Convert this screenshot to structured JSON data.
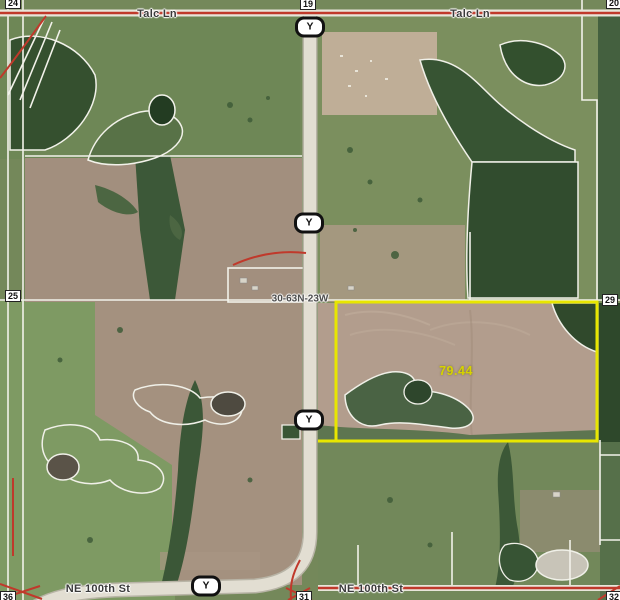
{
  "map": {
    "type": "county-gis-aerial-parcel-map",
    "township_range_label": "30-63N-23W",
    "highlighted_parcel": {
      "acreage": "79.44",
      "outline_color": "#e8e600"
    },
    "road_names": {
      "talc_ln_west": "Talc Ln",
      "talc_ln_east": "Talc Ln",
      "ne_100th_st_west": "NE 100th St",
      "ne_100th_st_east": "NE 100th St"
    },
    "route_shields": [
      {
        "route": "Y",
        "position": "top"
      },
      {
        "route": "Y",
        "position": "upper-middle"
      },
      {
        "route": "Y",
        "position": "lower-middle"
      },
      {
        "route": "Y",
        "position": "bottom"
      }
    ],
    "section_numbers": [
      {
        "corner": "northwest",
        "label": "24"
      },
      {
        "corner": "north",
        "label": "19"
      },
      {
        "corner": "northeast",
        "label": "20"
      },
      {
        "corner": "west",
        "label": "25"
      },
      {
        "corner": "east",
        "label": "29"
      },
      {
        "corner": "southwest",
        "label": "36"
      },
      {
        "corner": "south",
        "label": "31"
      },
      {
        "corner": "southeast",
        "label": "32"
      }
    ],
    "colors": {
      "parcel_highlight": "#e8e600",
      "acreage_text": "#d6d300",
      "paved_road_red": "#c0392b",
      "parcel_line_white": "#f2f2ea",
      "pasture_green": "#74885a",
      "tilled_field_brown": "#a28f7e",
      "forest_green": "#33502e"
    }
  }
}
